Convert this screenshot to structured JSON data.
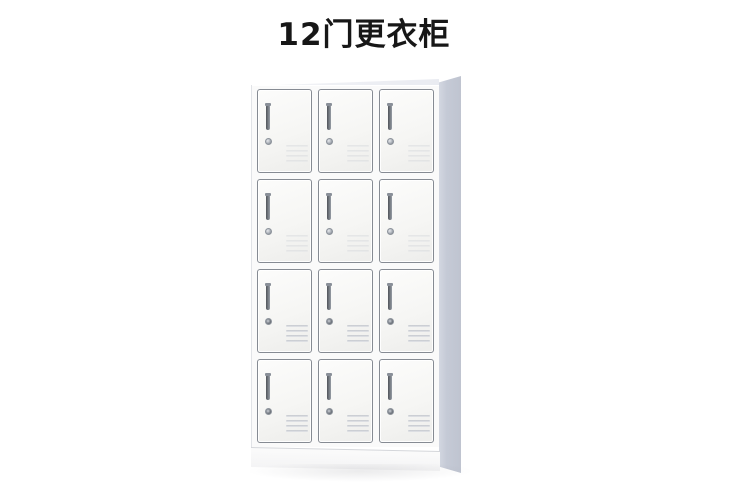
{
  "page": {
    "background_color": "#ffffff"
  },
  "title": {
    "text": "12门更衣柜",
    "color": "#171717"
  },
  "cabinet": {
    "kind": "12-door steel locker wardrobe",
    "rows": 4,
    "columns": 3,
    "door_count": 12,
    "door_parts": [
      "door-handle",
      "key-lock",
      "vent-slots"
    ],
    "colors": {
      "door_face": "#f6f6f4",
      "door_border": "#868b93",
      "body": "#fafafa",
      "side_panel": "#c5cad6",
      "base": "#f4f4f5",
      "handle": "#50545a"
    }
  }
}
